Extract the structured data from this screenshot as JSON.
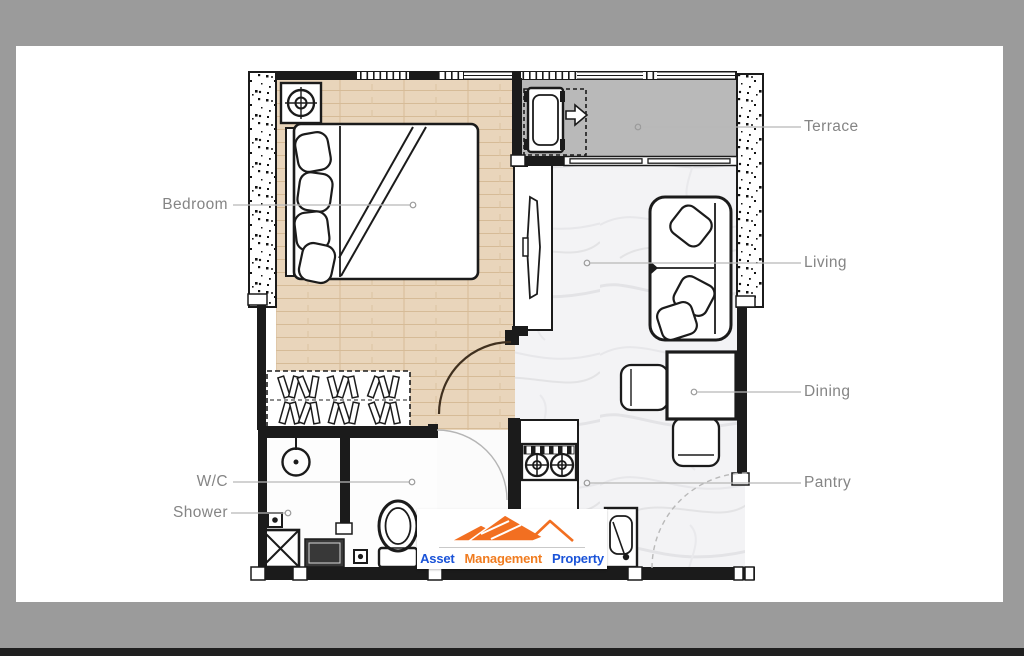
{
  "window": {
    "background": "#9b9b9b",
    "page_background": "#ffffff",
    "bottom_bar": "#1f1f1f"
  },
  "floor_plan": {
    "labels": {
      "bedroom": "Bedroom",
      "terrace": "Terrace",
      "living": "Living",
      "dining": "Dining",
      "pantry": "Pantry",
      "wc": "W/C",
      "shower": "Shower"
    },
    "colors": {
      "wall": "#1b1b1b",
      "wood_floor": "#e9d5bb",
      "marble_floor": "#f3f3f5",
      "terrace_floor": "#b9b9b9",
      "label_text": "#858585",
      "leader_line": "#b8b8b8",
      "door_swing": "#40301f"
    }
  },
  "watermark_logo": {
    "word_1": "Asset",
    "word_2": "Management",
    "word_3": "Property",
    "colors": {
      "word_1": "#1a53d8",
      "word_2": "#f07c20",
      "word_3": "#1a53d8",
      "mountain": "#f26f21",
      "background": "#ffffff"
    }
  }
}
